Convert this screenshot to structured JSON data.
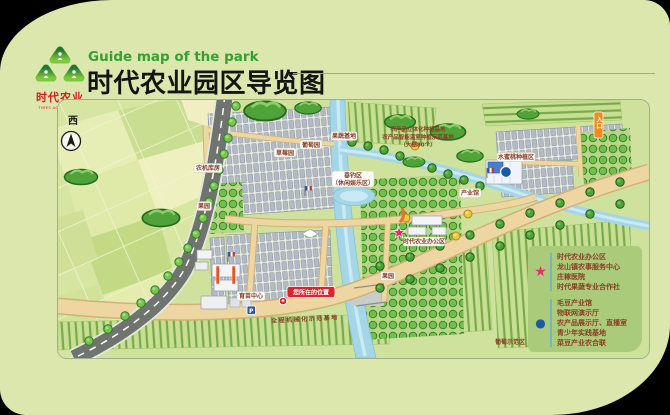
{
  "header": {
    "subtitle_en": "Guide map of the park",
    "title_cn": "时代农业园区导览图",
    "logo": {
      "brand_cn": "时代农业",
      "brand_en": "TIMES AGRICULTURE"
    }
  },
  "map": {
    "compass": "西",
    "parking_label": "P",
    "you_are_here": "您所在的位置",
    "road_text": "全程机械化示范基地",
    "labels": {
      "strawberry": "草莓园",
      "grape": "葡萄园",
      "fruit_base": "果蔬基地",
      "machinery_shed": "农机库房",
      "orchard_1": "果园",
      "orchard_2": "果园",
      "nursery_center": "育苗中心",
      "fishing_line1": "垂钓区",
      "fishing_line2": "（休闲娱乐区）",
      "industry_hall": "产业馆",
      "office_area": "时代农业办公区",
      "peach_area": "水蜜桃种植区",
      "grape_demo": "葡萄示范区",
      "entrance": "入口",
      "note_line1": "农产品立体化种植基地",
      "note_line2": "农产品智能温室种植示范基地",
      "note_line3": "（大棚80个）"
    }
  },
  "legend": {
    "star_marker": {
      "symbol": "★",
      "color": "#ea2a6e",
      "items": [
        "时代农业办公区",
        "龙山镇农事服务中心",
        "庄稼医院",
        "时代果蔬专业合作社"
      ]
    },
    "circle_marker": {
      "symbol": "●",
      "color": "#1c5aa6",
      "items": [
        "毛豆产业馆",
        "物联网演示厅",
        "农产品展示厅、直播室",
        "青少年实践基地",
        "菜豆产业农合联"
      ]
    }
  },
  "colors": {
    "accent_green": "#36a033",
    "card_bg": "#dce7ad",
    "legend_bg": "#aacb7a",
    "legend_text": "#8a3c22",
    "star_pink": "#ea2a6e",
    "marker_blue": "#1c5aa6",
    "you_are_here_red": "#d8262c"
  }
}
